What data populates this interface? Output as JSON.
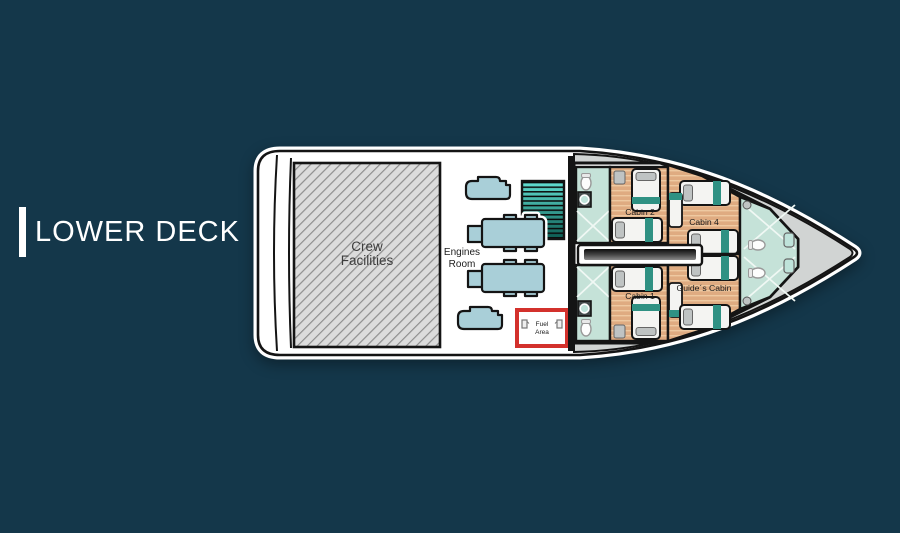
{
  "title": {
    "label": "LOWER DECK"
  },
  "boat": {
    "rooms": {
      "crew_facilities": {
        "line1": "Crew",
        "line2": "Facilities"
      },
      "engines_room": {
        "line1": "Engines",
        "line2": "Room"
      },
      "fuel_area": {
        "line1": "Fuel",
        "line2": "Area"
      },
      "cabin_2": {
        "label": "Cabin 2"
      },
      "cabin_1": {
        "label": "Cabin 1"
      },
      "cabin_4": {
        "label": "Cabin 4"
      },
      "guides_cabin": {
        "label": "Guide´s Cabin"
      }
    },
    "icons": [
      "engine-icon",
      "generator-icon",
      "stairs-icon",
      "fuel-pump-icon",
      "bed-icon",
      "toilet-icon",
      "sink-icon"
    ]
  },
  "colors": {
    "background": "#14374a",
    "title_white": "#ffffff",
    "hull_white": "#ffffff",
    "line_black": "#141414",
    "deck_gray": "#d1d4d3",
    "hatch_bg": "#dcdcdc",
    "hatch_line": "#8e8e8e",
    "wood_floor": "#dfab81",
    "wood_stripe": "#eec9a1",
    "tile_floor": "#c5e2d8",
    "engine_teal": "#a9cfd8",
    "stairs_light": "#63e2d5",
    "stairs_dark": "#0b5a50",
    "bed_white": "#f4f4f2",
    "bed_teal": "#2f9183",
    "pillow_gray": "#bfc3c3",
    "fuel_red": "#d3312c",
    "corridor_dark": "#141414"
  }
}
